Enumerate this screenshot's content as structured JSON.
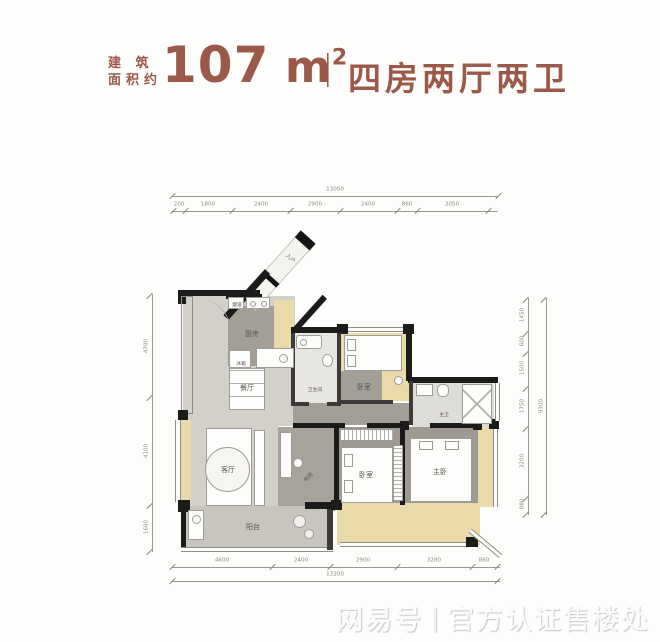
{
  "header": {
    "prefix_line1": "建 筑",
    "prefix_line2": "面积约",
    "area_value": "107",
    "area_unit": "m",
    "area_exponent": "2",
    "divider": "|",
    "layout_text": "四房两厅两卫",
    "accent_color": "#9b5a49"
  },
  "floorplan": {
    "labels": {
      "entry": "入户",
      "flue": "烟道",
      "kitchen": "厨房",
      "fridge": "冰箱",
      "dining": "餐厅",
      "bathroom": "卫生间",
      "bedroom_top": "卧室",
      "master_bath": "主卫",
      "living": "客厅",
      "study": "书房",
      "bedroom2": "卧室",
      "master_bedroom": "主卧",
      "balcony": "阳台"
    },
    "colors": {
      "wall": "#1b1b1a",
      "floor_light": "#d3d0ca",
      "floor_dark": "#a49f96",
      "floor_cream": "#ead9a9"
    },
    "dims": {
      "top": {
        "total": "13050",
        "segments": [
          "200",
          "1800",
          "2400",
          "2900",
          "2400",
          "860",
          "3050"
        ]
      },
      "bottom": {
        "total": "13200",
        "segments": [
          "4600",
          "2400",
          "2900",
          "3280",
          "860"
        ]
      },
      "left": {
        "segments": [
          "4700",
          "4100",
          "1600"
        ]
      },
      "right": {
        "total": "9300",
        "segments": [
          "1450",
          "600",
          "1500",
          "1750",
          "3200",
          "880"
        ]
      }
    }
  },
  "watermark": {
    "brand": "网易号",
    "separator": "|",
    "label": "官方认证售楼处"
  }
}
